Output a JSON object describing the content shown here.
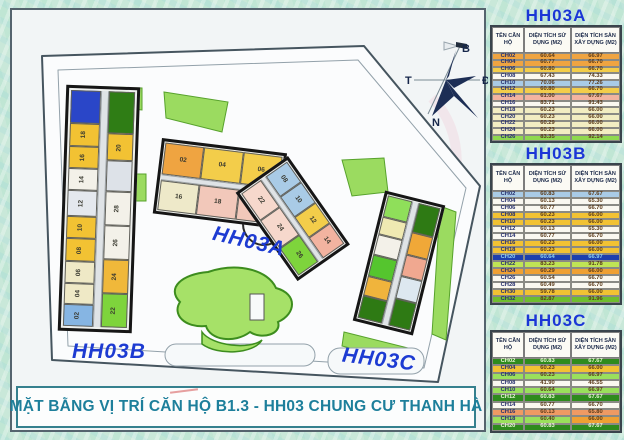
{
  "title_bar": {
    "text": "MẶT BẰNG VỊ TRÍ CĂN HỘ B1.3 - HH03 CHUNG CƯ THANH HÀ"
  },
  "plan": {
    "labels": {
      "hh03a": "HH03A",
      "hh03b": "HH03B",
      "hh03c": "HH03C"
    },
    "compass": {
      "north": "B",
      "south": "N",
      "east": "Đ",
      "west": "T"
    }
  },
  "colors": {
    "accent_blue": "#1b36d6",
    "title_teal": "#1d7f9b",
    "highlight_row_blue": "#1c3fae",
    "highlight_row_green": "#2e8b1d"
  },
  "tables": [
    {
      "id": "hh03a",
      "title": "HH03A",
      "headers": [
        "TÊN CĂN HỘ",
        "DIỆN TÍCH SỬ DỤNG (M2)",
        "DIỆN TÍCH SÀN XÂY DỰNG (M2)"
      ],
      "rows": [
        {
          "name": "CH02",
          "use": "60.64",
          "floor": "66.97",
          "bg": "#efa441"
        },
        {
          "name": "CH04",
          "use": "60.77",
          "floor": "66.70",
          "bg": "#efa441"
        },
        {
          "name": "CH06",
          "use": "60.80",
          "floor": "66.70",
          "bg": "#f3cd4a"
        },
        {
          "name": "CH08",
          "use": "67.43",
          "floor": "74.33",
          "bg": "#faf8f0"
        },
        {
          "name": "CH10",
          "use": "70.06",
          "floor": "77.26",
          "bg": "#a9cbe6"
        },
        {
          "name": "CH12",
          "use": "60.80",
          "floor": "66.70",
          "bg": "#f3cd4a"
        },
        {
          "name": "CH14",
          "use": "61.00",
          "floor": "67.67",
          "bg": "#f2b3a0"
        },
        {
          "name": "CH16",
          "use": "83.71",
          "floor": "91.43",
          "bg": "#faf8f0"
        },
        {
          "name": "CH18",
          "use": "60.23",
          "floor": "66.00",
          "bg": "#f2edc2"
        },
        {
          "name": "CH20",
          "use": "60.23",
          "floor": "66.00",
          "bg": "#f2edc2"
        },
        {
          "name": "CH22",
          "use": "60.29",
          "floor": "66.00",
          "bg": "#f2edc2"
        },
        {
          "name": "CH24",
          "use": "60.23",
          "floor": "66.00",
          "bg": "#f2edc2"
        },
        {
          "name": "CH26",
          "use": "83.35",
          "floor": "92.14",
          "bg": "#8fd94e"
        }
      ]
    },
    {
      "id": "hh03b",
      "title": "HH03B",
      "headers": [
        "TÊN CĂN HỘ",
        "DIỆN TÍCH SỬ DỤNG (M2)",
        "DIỆN TÍCH SÀN XÂY DỰNG (M2)"
      ],
      "rows": [
        {
          "name": "CH02",
          "use": "60.83",
          "floor": "67.67",
          "bg": "#a9cbe6"
        },
        {
          "name": "CH04",
          "use": "60.13",
          "floor": "65.30",
          "bg": "#faf8f0"
        },
        {
          "name": "CH06",
          "use": "60.77",
          "floor": "66.70",
          "bg": "#faf8f0"
        },
        {
          "name": "CH08",
          "use": "60.23",
          "floor": "66.00",
          "bg": "#f2c233"
        },
        {
          "name": "CH10",
          "use": "60.23",
          "floor": "66.00",
          "bg": "#f2c233"
        },
        {
          "name": "CH12",
          "use": "60.13",
          "floor": "65.30",
          "bg": "#faf8f0"
        },
        {
          "name": "CH14",
          "use": "60.77",
          "floor": "66.70",
          "bg": "#faf8f0"
        },
        {
          "name": "CH16",
          "use": "60.23",
          "floor": "66.00",
          "bg": "#f2c233"
        },
        {
          "name": "CH18",
          "use": "60.23",
          "floor": "66.00",
          "bg": "#f2c233"
        },
        {
          "name": "CH20",
          "use": "60.64",
          "floor": "66.97",
          "bg": "#1c3fae",
          "fg": "#8fd2ee"
        },
        {
          "name": "CH22",
          "use": "83.23",
          "floor": "91.78",
          "bg": "#bfe455"
        },
        {
          "name": "CH24",
          "use": "60.29",
          "floor": "66.00",
          "bg": "#efa033"
        },
        {
          "name": "CH26",
          "use": "60.54",
          "floor": "66.70",
          "bg": "#faf8f0"
        },
        {
          "name": "CH28",
          "use": "60.49",
          "floor": "66.70",
          "bg": "#faf8f0"
        },
        {
          "name": "CH30",
          "use": "59.78",
          "floor": "66.00",
          "bg": "#f2c233"
        },
        {
          "name": "CH32",
          "use": "82.87",
          "floor": "91.96",
          "bg": "#6fbe2e"
        }
      ]
    },
    {
      "id": "hh03c",
      "title": "HH03C",
      "headers": [
        "TÊN CĂN HỘ",
        "DIỆN TÍCH SỬ DỤNG (M2)",
        "DIỆN TÍCH SÀN XÂY DỰNG (M2)"
      ],
      "rows": [
        {
          "name": "CH02",
          "use": "60.83",
          "floor": "67.67",
          "bg": "#2e8b1d",
          "fg": "#e8f6d4"
        },
        {
          "name": "CH04",
          "use": "60.23",
          "floor": "66.00",
          "bg": "#f2c233"
        },
        {
          "name": "CH06",
          "use": "60.23",
          "floor": "66.97",
          "bg": "#9ae05c"
        },
        {
          "name": "CH08",
          "use": "41.90",
          "floor": "46.55",
          "bg": "#faf8f0"
        },
        {
          "name": "CH10",
          "use": "60.64",
          "floor": "66.97",
          "bg": "#9ae05c"
        },
        {
          "name": "CH12",
          "use": "60.83",
          "floor": "67.67",
          "bg": "#2e8b1d",
          "fg": "#e8f6d4"
        },
        {
          "name": "CH14",
          "use": "60.77",
          "floor": "66.70",
          "bg": "#faf8f0"
        },
        {
          "name": "CH16",
          "use": "60.13",
          "floor": "65.80",
          "bg": "#ef9a63"
        },
        {
          "name": "CH18",
          "use": "60.40",
          "floor": "66.00",
          "bg": "#9ae05c",
          "floor_bg": "#efa033"
        },
        {
          "name": "CH20",
          "use": "60.83",
          "floor": "67.67",
          "bg": "#2e8b1d",
          "fg": "#e8f6d4"
        }
      ]
    }
  ],
  "buildings": {
    "hh03b": {
      "left": [
        {
          "label": "",
          "color": "#2a46c8",
          "f": 1.5
        },
        {
          "label": "18",
          "color": "#f2c233",
          "f": 1
        },
        {
          "label": "16",
          "color": "#f2c233",
          "f": 1
        },
        {
          "label": "14",
          "color": "#f3f1e9",
          "f": 0.95
        },
        {
          "label": "12",
          "color": "#e4e8ee",
          "f": 1.15
        },
        {
          "label": "10",
          "color": "#f2c233",
          "f": 1
        },
        {
          "label": "08",
          "color": "#f2c233",
          "f": 1
        },
        {
          "label": "06",
          "color": "#efe9c6",
          "f": 0.95
        },
        {
          "label": "04",
          "color": "#efe9c6",
          "f": 0.95
        },
        {
          "label": "02",
          "color": "#86b5e3",
          "f": 0.95
        }
      ],
      "right": [
        {
          "label": "",
          "color": "#2f7d15",
          "f": 1.7
        },
        {
          "label": "20",
          "color": "#f2c233",
          "f": 1.05
        },
        {
          "label": "",
          "color": "#dde2e8",
          "f": 1.2
        },
        {
          "label": "28",
          "color": "#f3f1e9",
          "f": 1.35
        },
        {
          "label": "26",
          "color": "#f3f1e9",
          "f": 1.35
        },
        {
          "label": "24",
          "color": "#f0b83a",
          "f": 1.35
        },
        {
          "label": "22",
          "color": "#7ed43c",
          "f": 1.35
        }
      ]
    },
    "hh03a": {
      "seg1_top": [
        {
          "label": "02",
          "color": "#efa441",
          "f": 1
        },
        {
          "label": "04",
          "color": "#f3cd4a",
          "f": 1
        },
        {
          "label": "06",
          "color": "#f3cd4a",
          "f": 1
        }
      ],
      "seg1_bottom": [
        {
          "label": "16",
          "color": "#eee9c9",
          "f": 1
        },
        {
          "label": "18",
          "color": "#f2c8ba",
          "f": 1
        },
        {
          "label": "20",
          "color": "#f2c8ba",
          "f": 1
        }
      ],
      "seg2_top": [
        {
          "label": "08",
          "color": "#a9cbe6",
          "f": 1
        },
        {
          "label": "10",
          "color": "#a9cbe6",
          "f": 1
        },
        {
          "label": "12",
          "color": "#f3cd4a",
          "f": 1
        },
        {
          "label": "14",
          "color": "#f2b3a0",
          "f": 1
        }
      ],
      "seg2_bottom": [
        {
          "label": "22",
          "color": "#f6d8cc",
          "f": 1
        },
        {
          "label": "24",
          "color": "#f6d8cc",
          "f": 1
        },
        {
          "label": "26",
          "color": "#7ed43c",
          "f": 1
        }
      ]
    },
    "hh03c": {
      "left": [
        {
          "label": "",
          "color": "#8fdf5a",
          "f": 1.2
        },
        {
          "label": "",
          "color": "#efe9b2",
          "f": 1
        },
        {
          "label": "",
          "color": "#f3f1e9",
          "f": 1.2
        },
        {
          "label": "",
          "color": "#55c52e",
          "f": 1.2
        },
        {
          "label": "",
          "color": "#f0b43c",
          "f": 1.1
        },
        {
          "label": "",
          "color": "#2e7a14",
          "f": 1.3
        }
      ],
      "right": [
        {
          "label": "",
          "color": "#2e7a14",
          "f": 1.5
        },
        {
          "label": "",
          "color": "#f0a838",
          "f": 1.1
        },
        {
          "label": "",
          "color": "#f0a890",
          "f": 1.1
        },
        {
          "label": "",
          "color": "#dde8f0",
          "f": 1.1
        },
        {
          "label": "",
          "color": "#2e7a14",
          "f": 1.4
        }
      ]
    }
  }
}
